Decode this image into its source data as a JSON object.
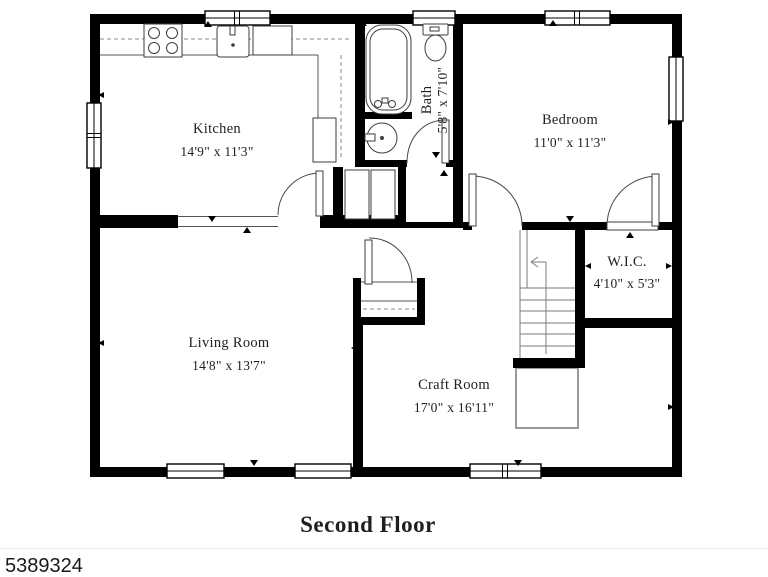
{
  "plan": {
    "title": "Second Floor",
    "watermark": "5389324",
    "rooms": [
      {
        "name": "Kitchen",
        "dims": "14'9\" x 11'3\""
      },
      {
        "name": "Bath",
        "dims": "5'8\" x 7'10\""
      },
      {
        "name": "Bedroom",
        "dims": "11'0\" x 11'3\""
      },
      {
        "name": "Living Room",
        "dims": "14'8\" x 13'7\""
      },
      {
        "name": "Craft Room",
        "dims": "17'0\" x 16'11\""
      },
      {
        "name": "W.I.C.",
        "dims": "4'10\" x 5'3\""
      }
    ],
    "colors": {
      "wall": "#000000",
      "fixture": "#3d3d3d",
      "text": "#1f1f1f"
    }
  }
}
